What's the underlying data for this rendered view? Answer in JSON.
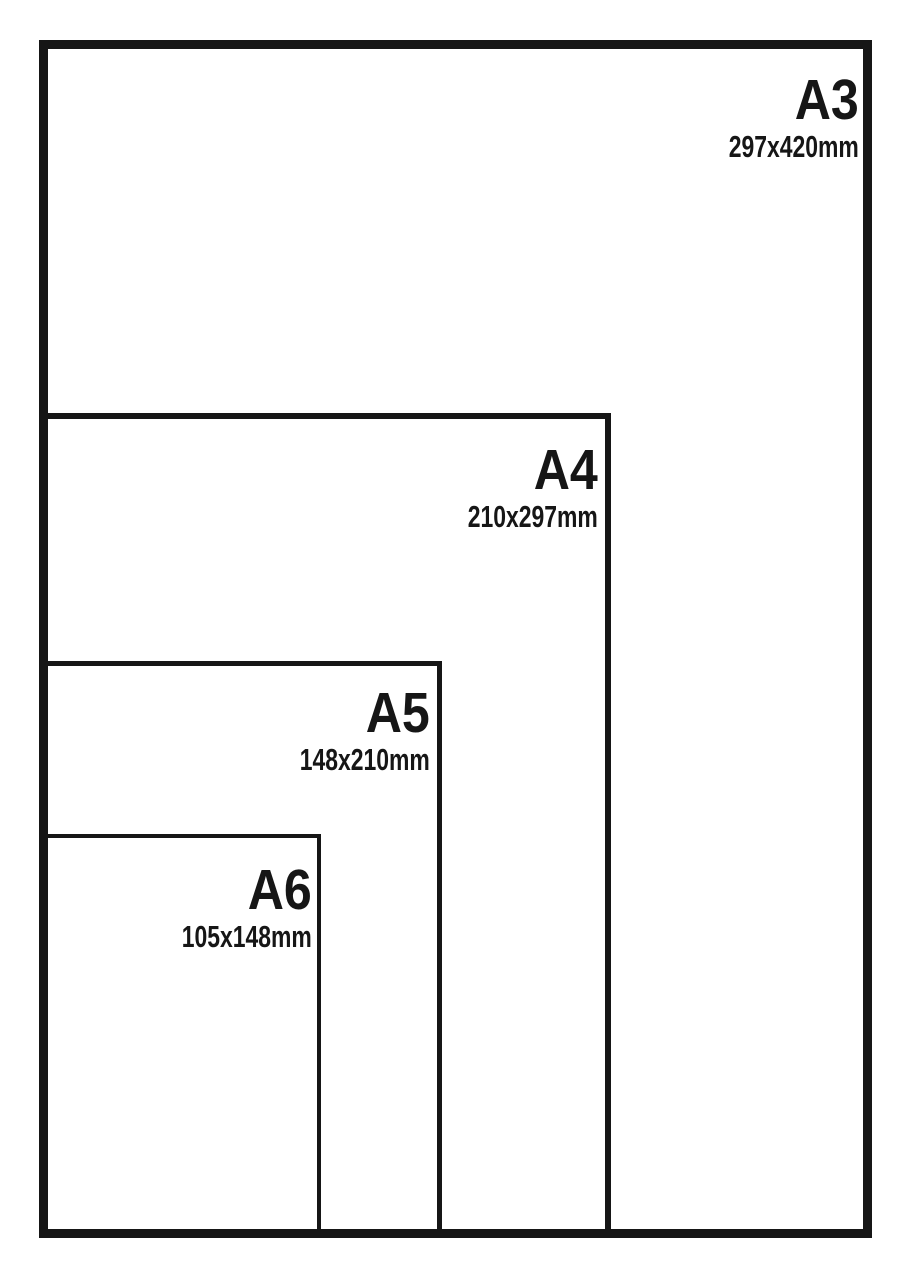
{
  "diagram": {
    "type": "nested-rectangles",
    "subject": "paper-size-comparison",
    "background_color": "#ffffff",
    "line_color": "#161616",
    "text_color": "#161616",
    "sizes": [
      {
        "label": "A3",
        "dimensions": "297x420mm"
      },
      {
        "label": "A4",
        "dimensions": "210x297mm"
      },
      {
        "label": "A5",
        "dimensions": "148x210mm"
      },
      {
        "label": "A6",
        "dimensions": "105x148mm"
      }
    ]
  }
}
